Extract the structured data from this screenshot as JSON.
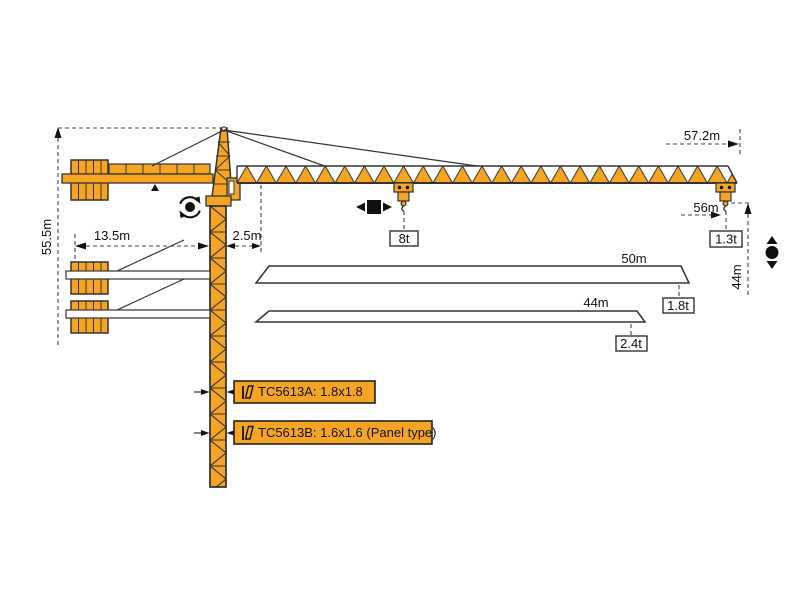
{
  "title": "TC5613 tower crane dimension and load diagram",
  "colors": {
    "crane": "#F6A423",
    "outline": "#333333",
    "dash": "#444444",
    "icon": "#111111",
    "bar": "#FFFFFF"
  },
  "dimensions": {
    "mast_height": "55.5m",
    "counter_jib_radius": "13.5m",
    "rear_offset": "2.5m",
    "max_radius": "57.2m",
    "hook_radius": "56m",
    "lift_height": "44m"
  },
  "loads": {
    "max_capacity": "8t",
    "tip_load_full_jib": "1.3t"
  },
  "jib_variants": [
    {
      "length": "50m",
      "tip_load": "1.8t"
    },
    {
      "length": "44m",
      "tip_load": "2.4t"
    }
  ],
  "mast_sections": [
    {
      "label": "TC5613A: 1.8x1.8"
    },
    {
      "label": "TC5613B: 1.6x1.6 (Panel type)"
    }
  ],
  "icons": {
    "slew": "slew-rotation-icon",
    "travel": "trolley-travel-icon",
    "hoist": "hoist-up-down-icon",
    "mast_section": "mast-section-icon"
  }
}
